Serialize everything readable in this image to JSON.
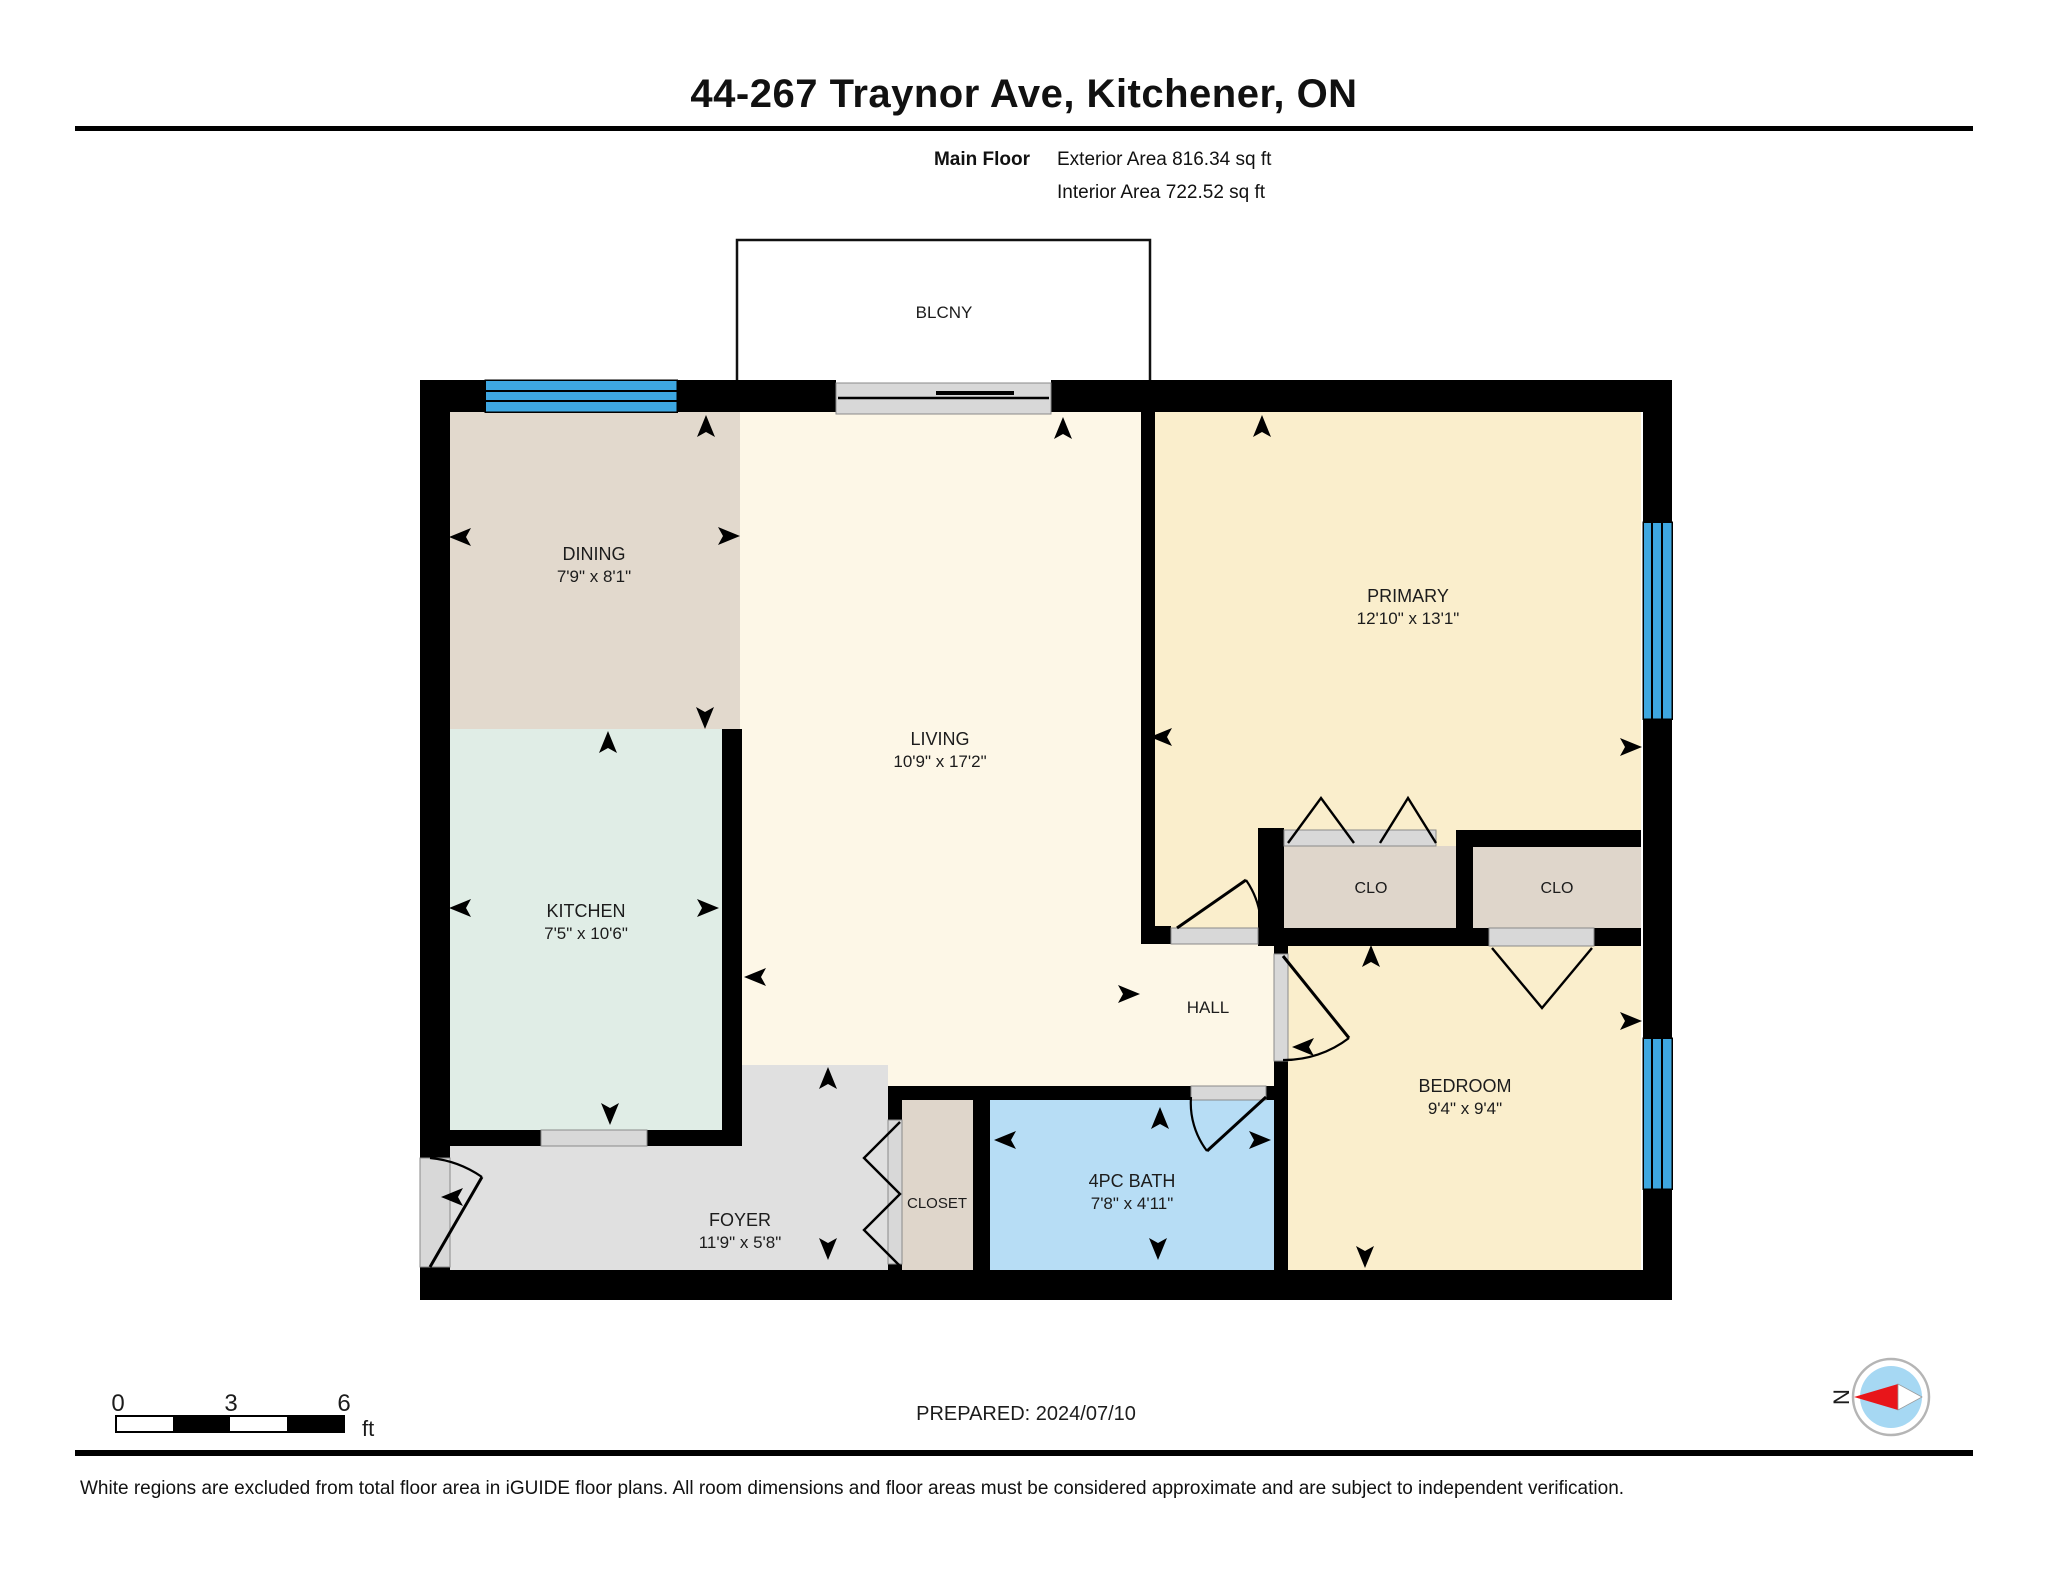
{
  "header": {
    "title": "44-267 Traynor Ave, Kitchener, ON",
    "floor_label": "Main Floor",
    "exterior_area": "Exterior Area 816.34 sq ft",
    "interior_area": "Interior Area 722.52 sq ft"
  },
  "floorplan": {
    "balcony_label": "BLCNY",
    "rooms": [
      {
        "name": "DINING",
        "dims": "7'9\" x 8'1\""
      },
      {
        "name": "KITCHEN",
        "dims": "7'5\" x 10'6\""
      },
      {
        "name": "LIVING",
        "dims": "10'9\" x 17'2\""
      },
      {
        "name": "PRIMARY",
        "dims": "12'10\" x 13'1\""
      },
      {
        "name": "BEDROOM",
        "dims": "9'4\" x 9'4\""
      },
      {
        "name": "4PC BATH",
        "dims": "7'8\" x 4'11\""
      },
      {
        "name": "FOYER",
        "dims": "11'9\" x 5'8\""
      },
      {
        "name": "HALL"
      },
      {
        "name": "CLOSET"
      },
      {
        "name": "CLO"
      },
      {
        "name": "CLO"
      }
    ]
  },
  "scale_bar": {
    "ticks": [
      "0",
      "3",
      "6"
    ],
    "unit": "ft"
  },
  "prepared_label": "PREPARED: 2024/07/10",
  "compass": {
    "north_label": "N",
    "needle_color": "#e8151a"
  },
  "footer": "White regions are excluded from total floor area in iGUIDE floor plans. All room dimensions and floor areas must be considered approximate and are subject to independent verification.",
  "colors": {
    "wall": "#000000",
    "living_hall": "#fdf7e7",
    "primary_bedroom": "#faeecc",
    "dining": "#e2d9cd",
    "kitchen": "#e0ede6",
    "bath": "#b7ddf5",
    "foyer": "#e0e0e0",
    "closet": "#dfd6cb",
    "window": "#3ea7e1",
    "door_sill": "#d8d8d8",
    "compass_inner": "#a6d8f3"
  }
}
